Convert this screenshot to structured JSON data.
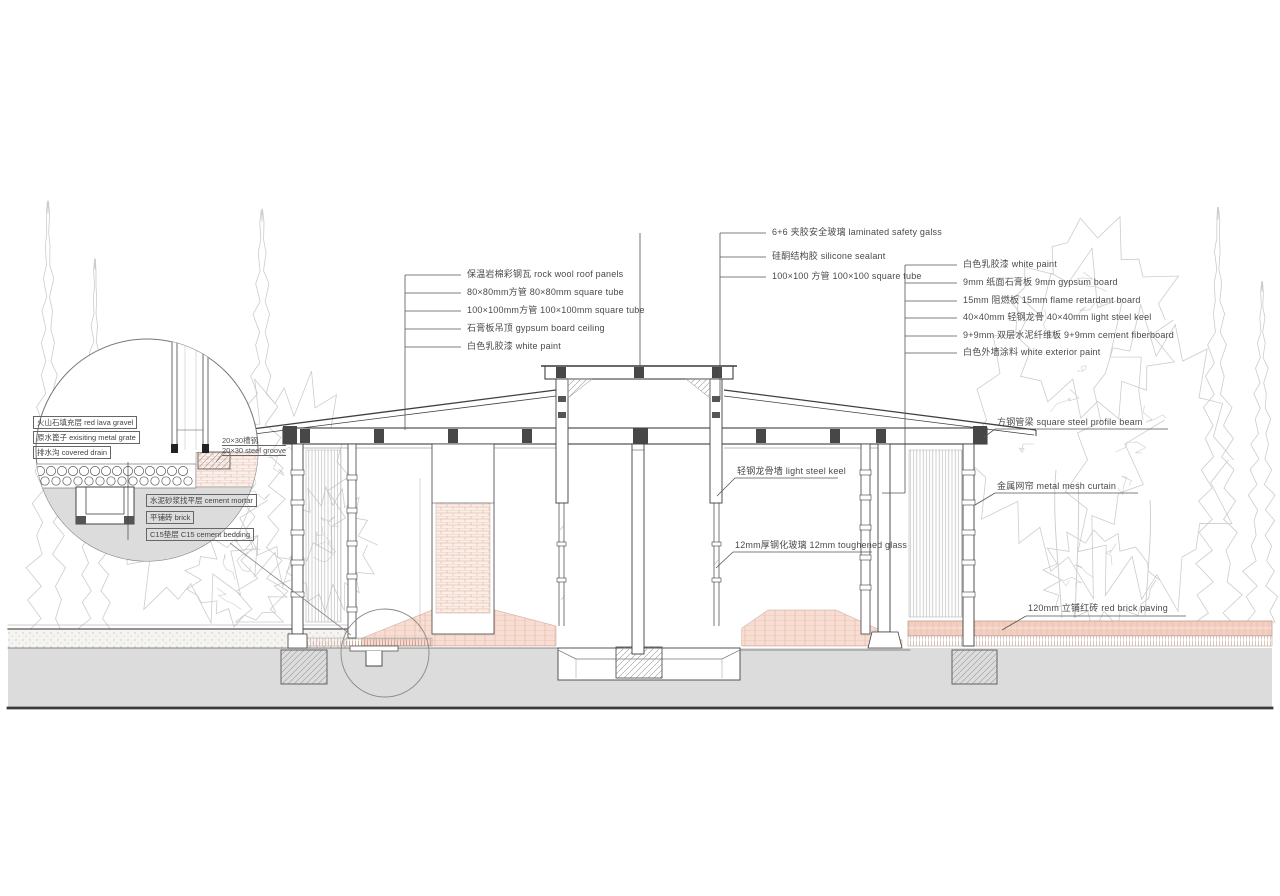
{
  "annotations": {
    "top_center": [
      "6+6 夹胶安全玻璃  laminated safety galss",
      "硅酮结构胶  silicone sealant",
      "100×100 方管 100×100 square tube"
    ],
    "left": [
      "保温岩棉彩钢瓦  rock wool roof panels",
      "80×80mm方管  80×80mm square tube",
      "100×100mm方管 100×100mm square tube",
      "石膏板吊顶 gypsum board ceiling",
      "白色乳胶漆 white paint"
    ],
    "right": [
      "白色乳胶漆  white  paint",
      "9mm 纸面石膏板  9mm gypsum board",
      "15mm 阻燃板  15mm flame retardant board",
      "40×40mm 轻钢龙骨  40×40mm light steel keel",
      "9+9mm 双层水泥纤维板  9+9mm cement fiberboard",
      "白色外墙涂料  white exterior paint"
    ],
    "building": {
      "light_steel_keel": "轻钢龙骨墙 light steel keel",
      "toughened_glass": "12mm厚钢化玻璃 12mm toughened glass",
      "profile_beam": "方钢管梁 square steel profile beam",
      "mesh_curtain": "金属网帘 metal mesh curtain",
      "brick_paving": "120mm 立铺红砖 red brick paving"
    },
    "detail_circle": {
      "boxes_top": [
        "火山石填充层 red lava gravel",
        "原水篦子 exisiting metal grate",
        "排水沟 covered drain"
      ],
      "boxes_bottom": [
        "水泥砂浆找平层 cement mortar",
        "平铺砖 brick",
        "C15垫层 C15 cement bedding"
      ],
      "groove_zh": "20×30槽钢",
      "groove_en": "20×30 steel groove"
    }
  },
  "colors": {
    "brick_paving": "#f2cfc0",
    "interior_brick": "#f7ddd2",
    "ground": "#dcdcdc",
    "line": "#3f3f3f",
    "tree_outline": "#cccccc"
  }
}
